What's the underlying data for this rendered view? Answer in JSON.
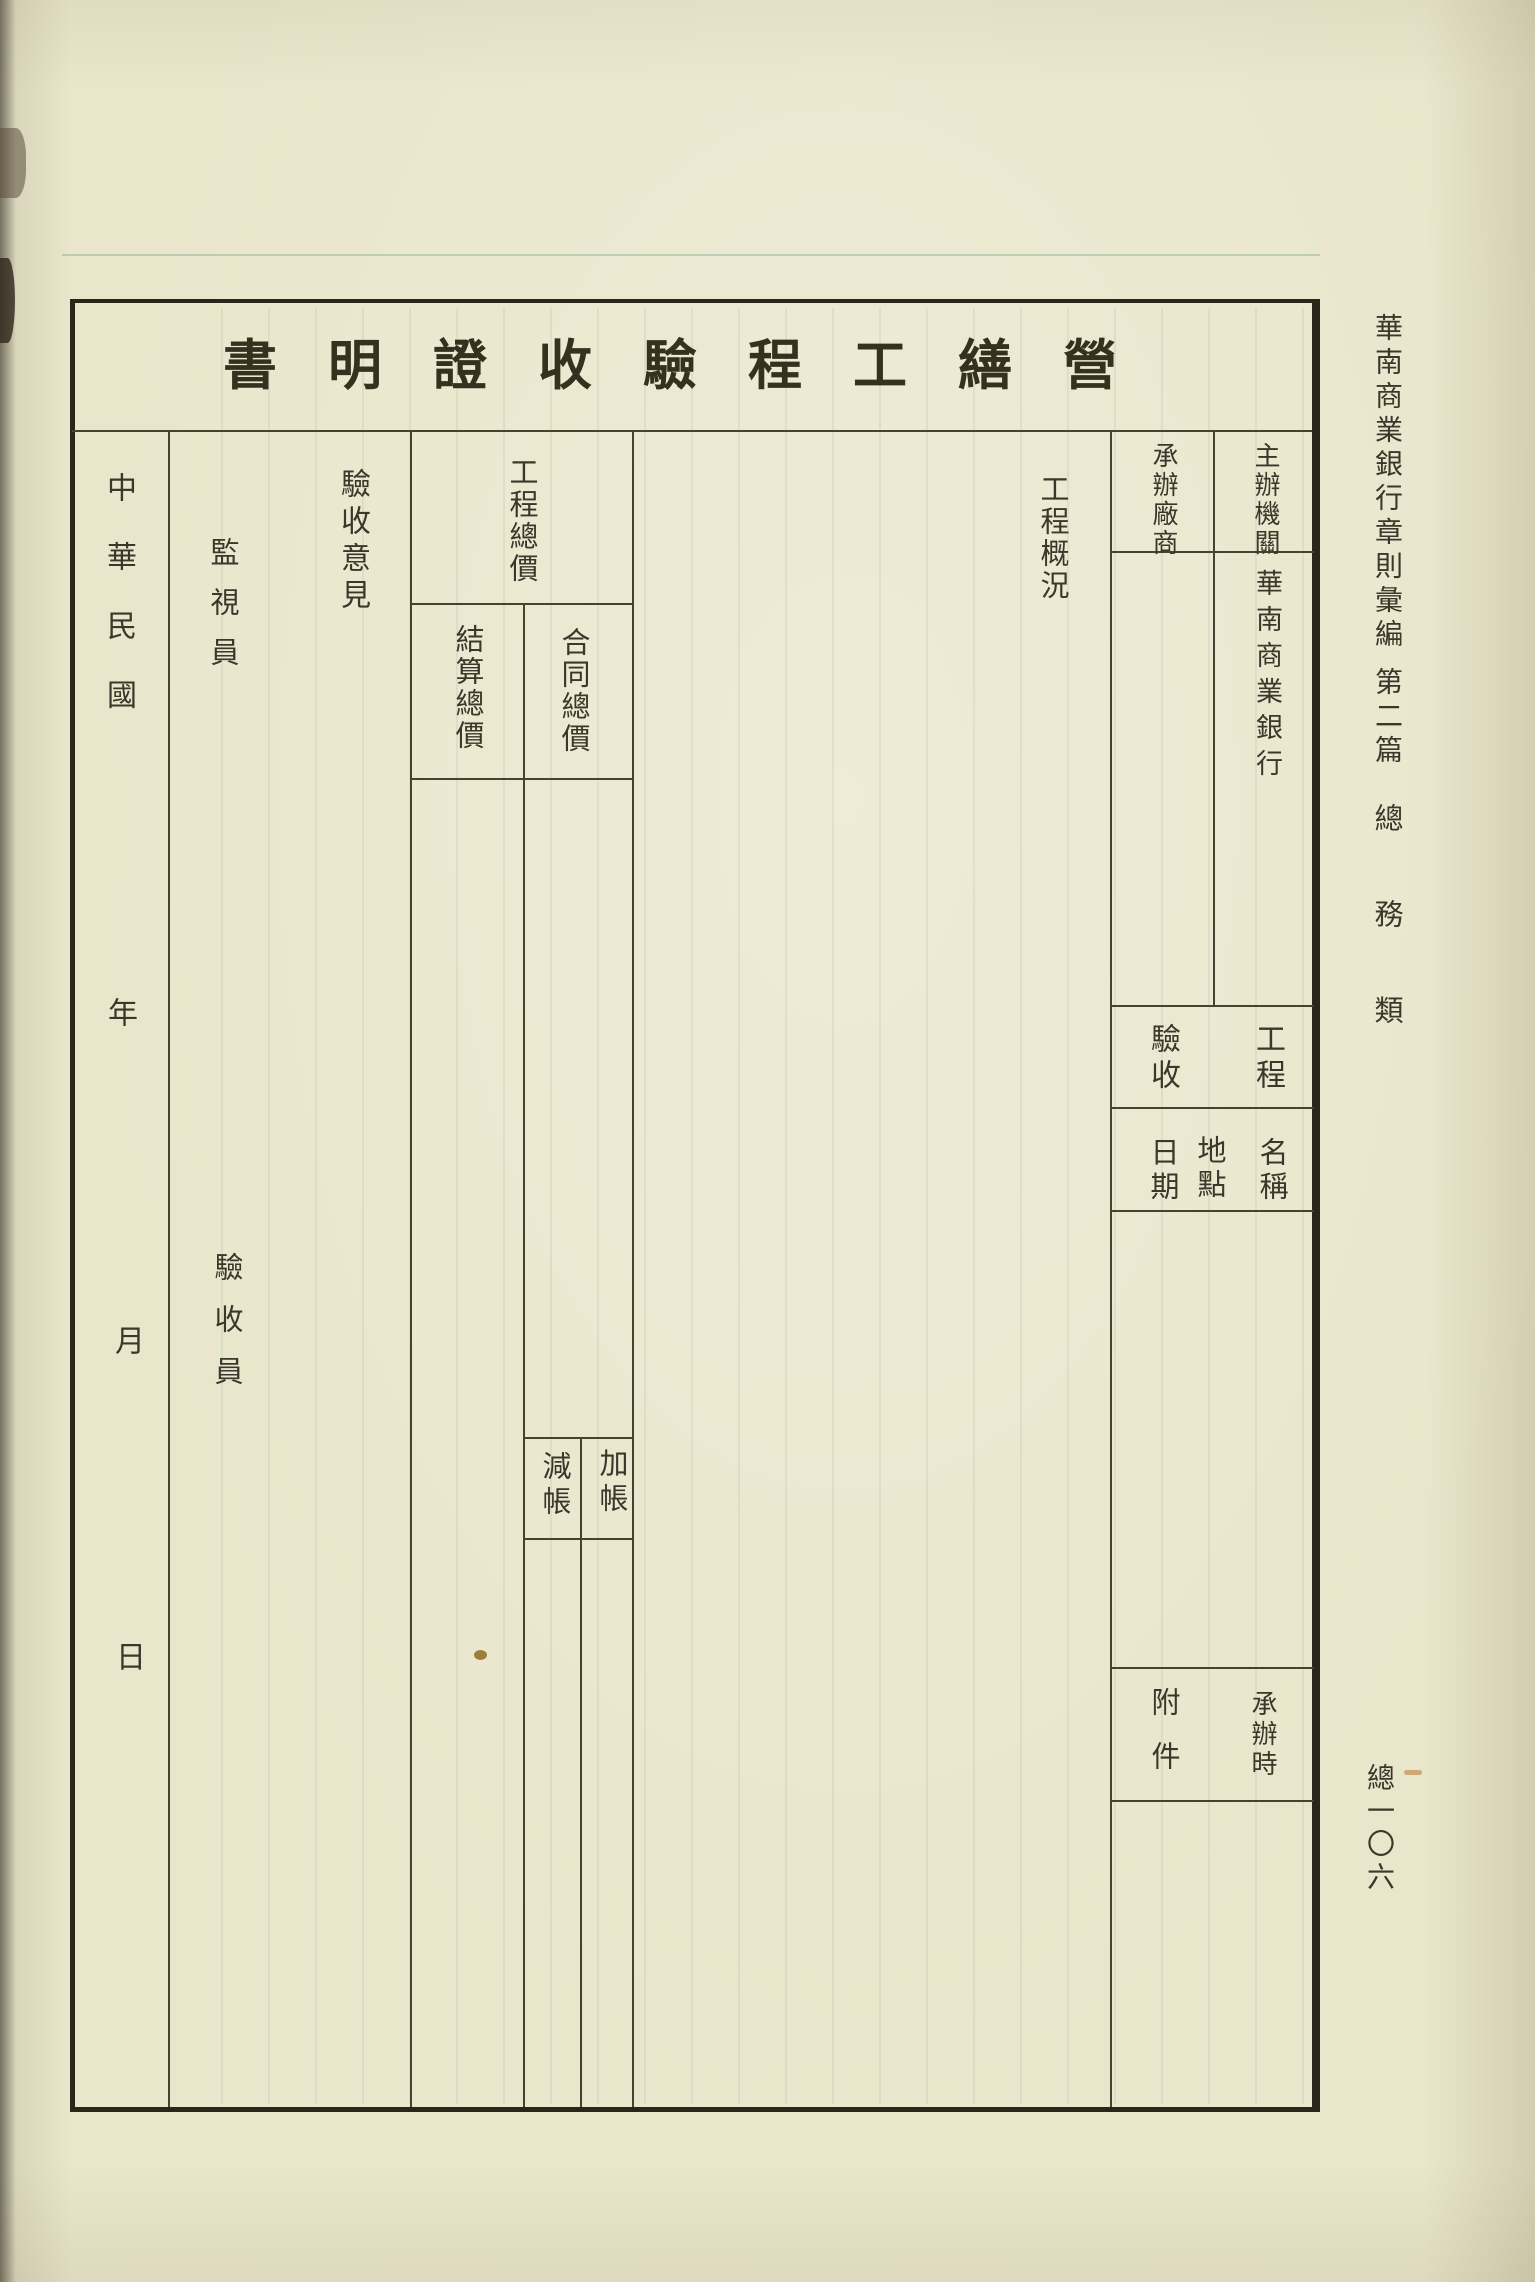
{
  "page": {
    "paper_color": "#e9e6cc",
    "ink_color": "#3b372a",
    "table_line_color": "#474130"
  },
  "margin": {
    "book_title": "華南商業銀行章則彙編",
    "section": "第二篇",
    "category": "總務類",
    "page_number": "總一〇六"
  },
  "form": {
    "title_display": "書明證收驗程工繕營",
    "title_reading": "營繕工程驗收證明書",
    "header": {
      "organizer_label": "主辦機關",
      "organizer_value": "華南商業銀行",
      "contractor_label": "承辦廠商",
      "project_label": "工程",
      "name_label": "名稱",
      "location_label": "地點",
      "acceptance_label": "驗收",
      "date_label": "日期",
      "at_contract_label": "承辦時",
      "attachments_label": "附件"
    },
    "body": {
      "overview_label": "工程概況",
      "total_price_label": "工程總價",
      "contract_total_label": "合同總價",
      "settlement_total_label": "結算總價",
      "additions_label": "加帳",
      "deductions_label": "減帳",
      "opinion_label": "驗收意見",
      "supervisor_label": "監視員",
      "inspector_label": "驗收員"
    },
    "date_line": {
      "era_label": "中華民國",
      "year_label": "年",
      "month_label": "月",
      "day_label": "日"
    }
  }
}
